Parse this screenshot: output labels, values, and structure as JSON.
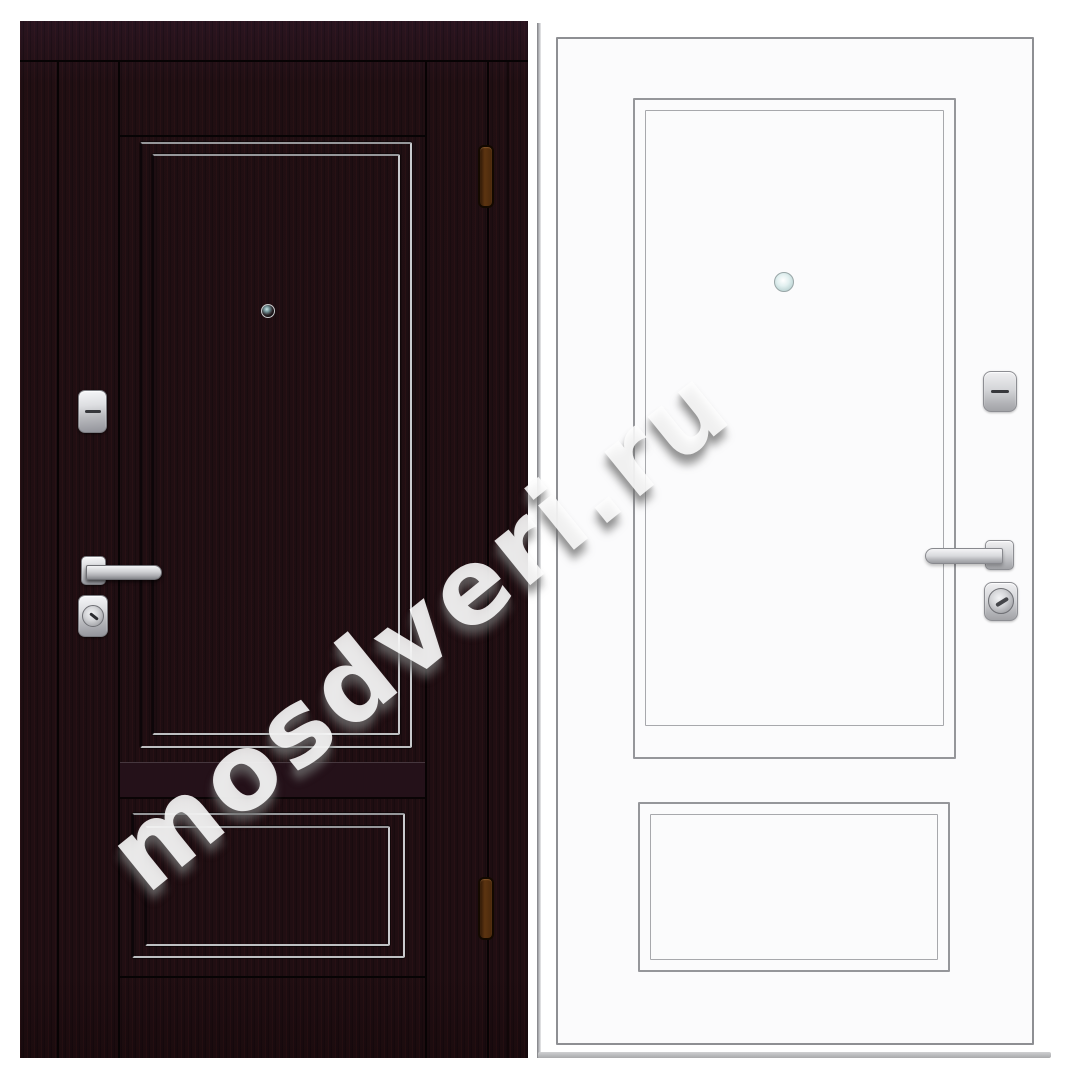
{
  "watermark": {
    "text": "mosdveri.ru"
  },
  "views": {
    "left": "entrance-door-exterior-dark-wenge",
    "right": "entrance-door-interior-white"
  },
  "colors": {
    "wenge_base": "#1e0e11",
    "wenge_joint": "#070304",
    "molding_highlight": "#c9cacd",
    "white_leaf": "#fbfbfc",
    "outline_gray": "#8e8f93",
    "chrome_hardware": "#d6d7da",
    "hinge_amber": "#5c3411",
    "peephole_glass": "#c6e4e6"
  }
}
